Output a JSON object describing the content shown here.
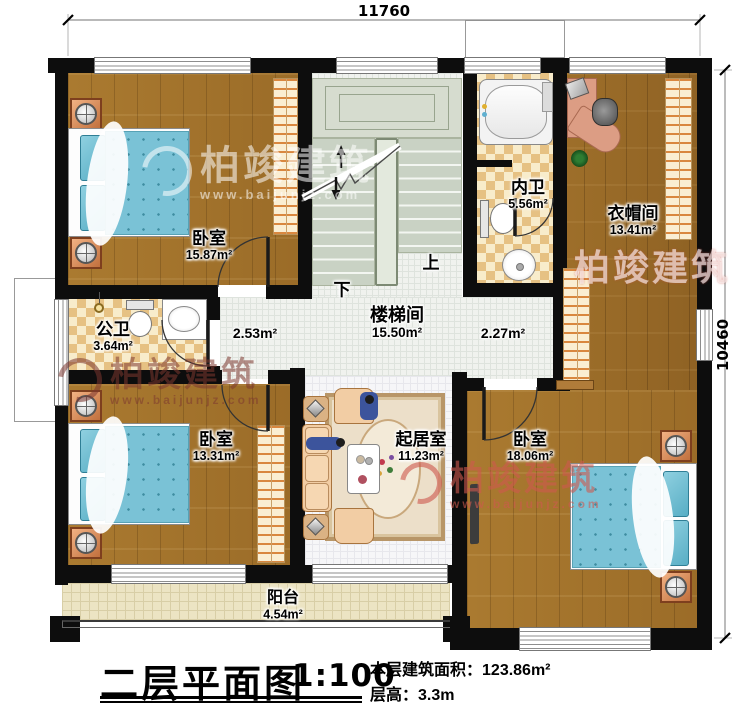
{
  "watermark": {
    "brand": "柏竣建筑",
    "url": "www.baijunjz.com"
  },
  "dimensions": {
    "top": "11760",
    "right": "10460"
  },
  "stairs": {
    "up": "上",
    "down": "下"
  },
  "rooms": {
    "bedroom_tl": {
      "name": "卧室",
      "area": "15.87m²"
    },
    "bath_inner": {
      "name": "内卫",
      "area": "5.56m²"
    },
    "cloakroom": {
      "name": "衣帽间",
      "area": "13.41m²"
    },
    "bath_public": {
      "name": "公卫",
      "area": "3.64m²"
    },
    "stairwell": {
      "name": "楼梯间",
      "area": "15.50m²"
    },
    "hall_left": {
      "area": "2.53m²"
    },
    "hall_right": {
      "area": "2.27m²"
    },
    "bedroom_bl": {
      "name": "卧室",
      "area": "13.31m²"
    },
    "living_room": {
      "name": "起居室",
      "area": "11.23m²"
    },
    "bedroom_br": {
      "name": "卧室",
      "area": "18.06m²"
    },
    "balcony": {
      "name": "阳台",
      "area": "4.54m²"
    }
  },
  "title_block": {
    "title": "二层平面图",
    "scale": "1:100",
    "floor_area_label": "本层建筑面积：",
    "floor_area_value": "123.86m²",
    "floor_height_label": "层高：",
    "floor_height_value": "3.3m"
  },
  "colors": {
    "wall": "#0d0d0d",
    "wood_floor": "#a5762e",
    "bed_blanket": "#7ac2d6",
    "bath_tile": "#e6c183",
    "balcony_floor": "#ece4c3",
    "watermark_red": "#c65b50"
  }
}
